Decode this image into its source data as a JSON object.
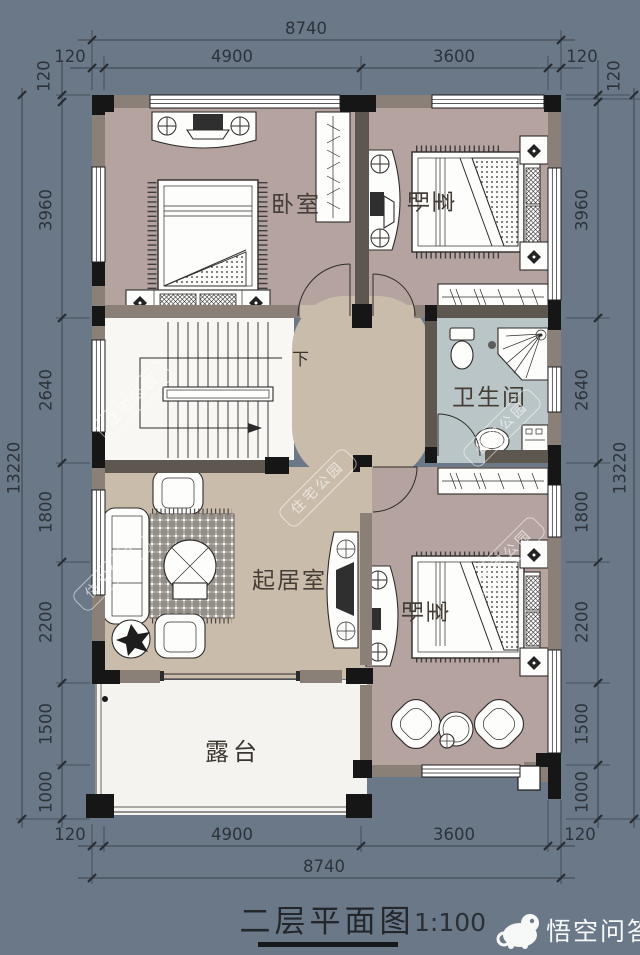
{
  "title": {
    "text": "二层平面图",
    "scale": "1:100"
  },
  "rooms": {
    "bedroom_top_left": "卧室",
    "bedroom_top_right": "卧室",
    "bedroom_bottom_right": "卧室",
    "bathroom": "卫生间",
    "living_room": "起居室",
    "terrace": "露台",
    "stairs_down": "下"
  },
  "dims": {
    "top": {
      "total": "8740",
      "segments": [
        "120",
        "4900",
        "3600",
        "120"
      ]
    },
    "bottom": {
      "total": "8740",
      "segments": [
        "120",
        "4900",
        "3600",
        "120"
      ]
    },
    "left": {
      "total": "13220",
      "offset_top": "120",
      "segments": [
        "3960",
        "2640",
        "1800",
        "2200",
        "1500",
        "1000"
      ]
    },
    "right": {
      "total": "13220",
      "offset_top": "120",
      "segments": [
        "3960",
        "2640",
        "1800",
        "2200",
        "1500",
        "1000"
      ]
    }
  },
  "watermarks": {
    "site": "住宅公园",
    "brand": "悟空问答"
  },
  "colors": {
    "background": "#6b7888",
    "bedroom_floor": "#b4a39f",
    "living_floor": "#cabcab",
    "bath_floor": "#b9c5c6",
    "terrace_floor": "#f4f3ef",
    "wall_black": "#161616",
    "wall_fill": "#8a8077",
    "dim_text": "#2d333b"
  }
}
